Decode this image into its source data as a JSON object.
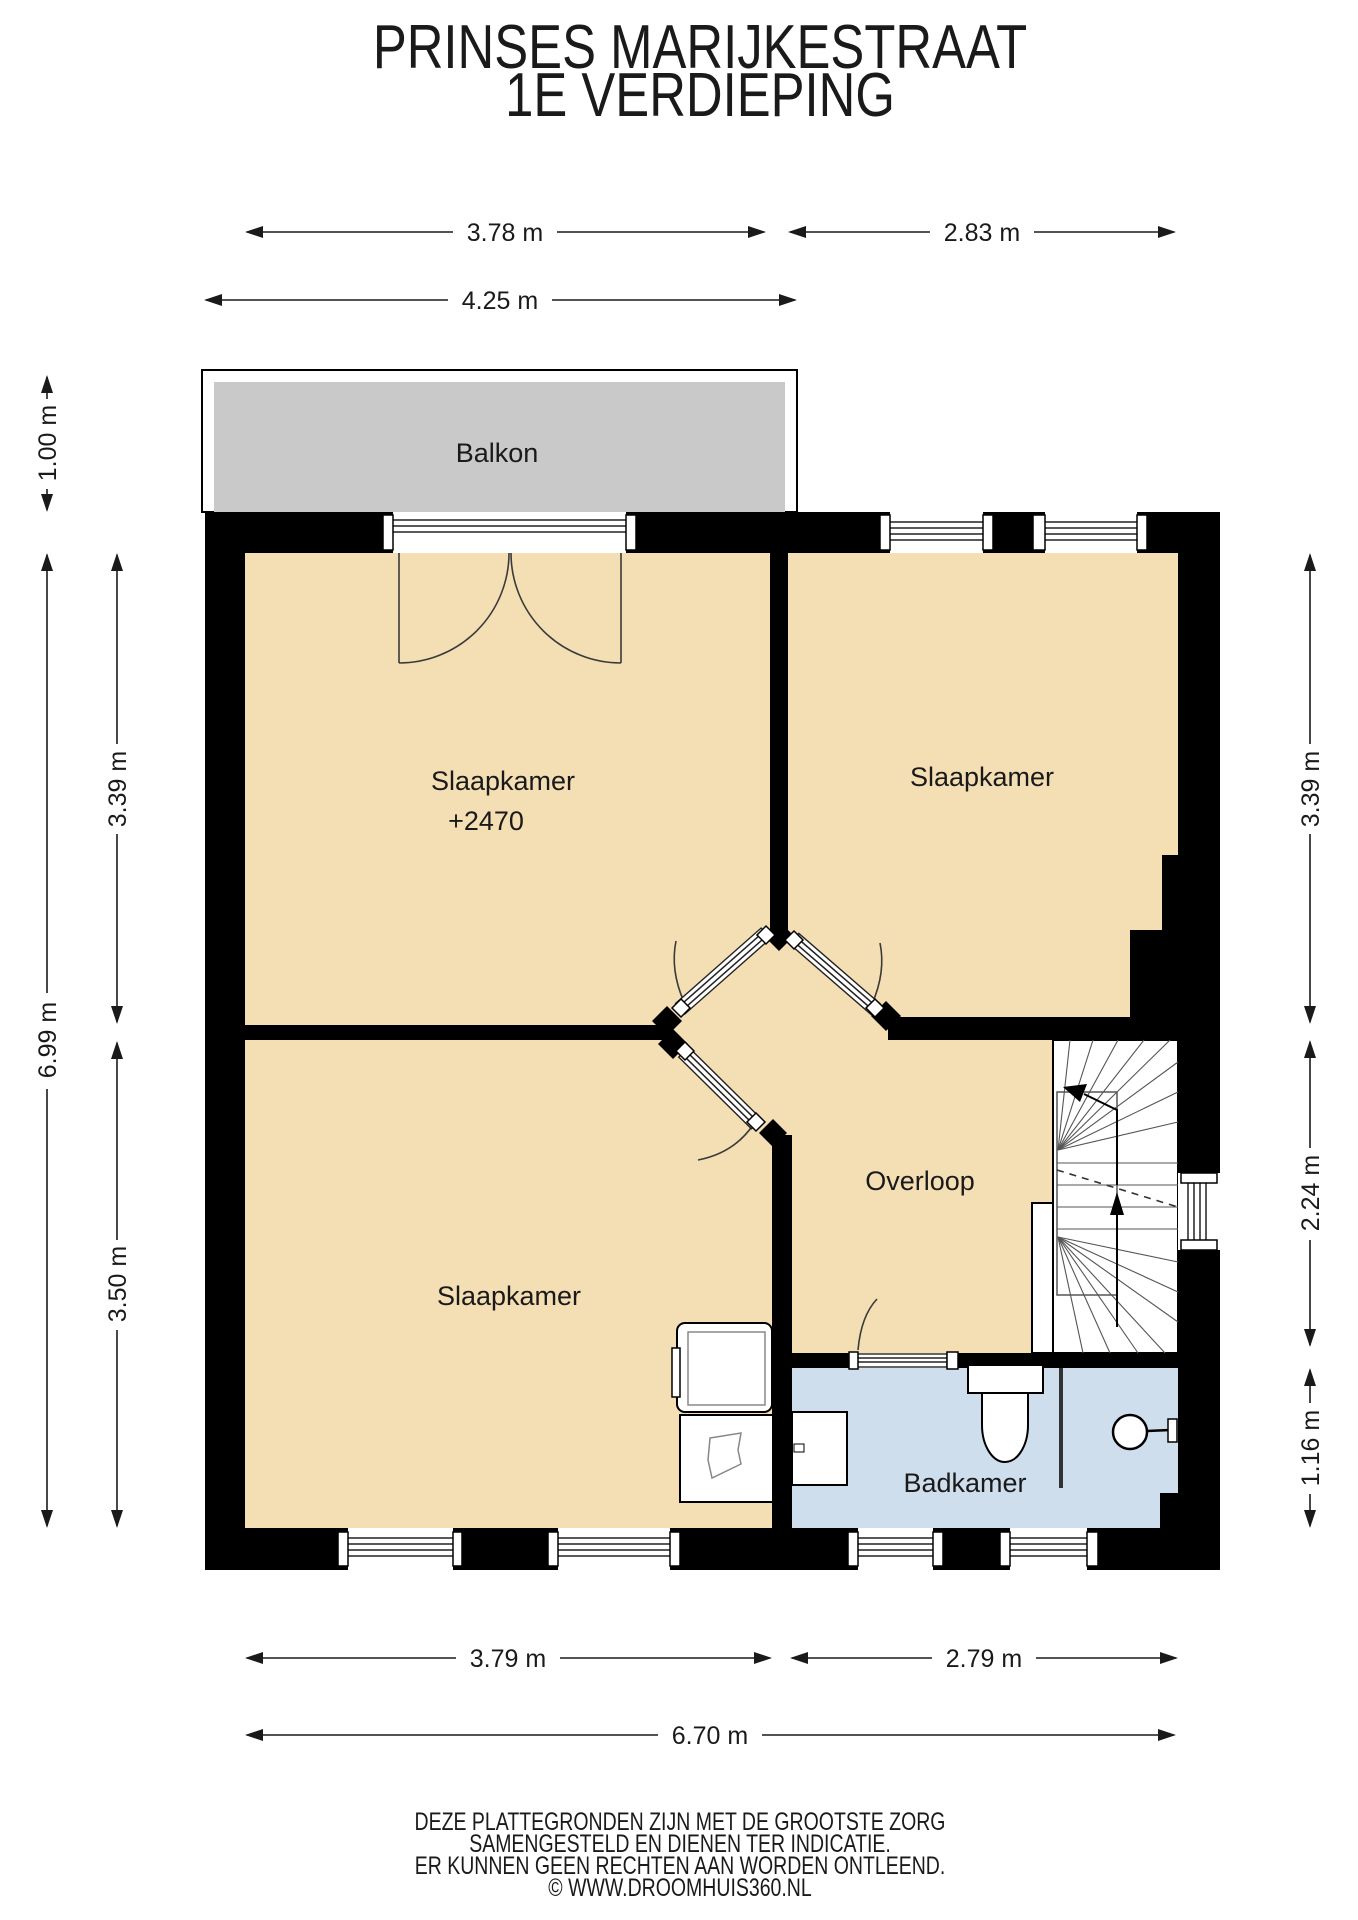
{
  "title": {
    "line1": "PRINSES MARIJKESTRAAT",
    "line2": "1E VERDIEPING"
  },
  "rooms": {
    "balcony": "Balkon",
    "bedroom_tl": "Slaapkamer",
    "bedroom_tl_level": "+2470",
    "bedroom_tr": "Slaapkamer",
    "bedroom_bl": "Slaapkamer",
    "landing": "Overloop",
    "bathroom": "Badkamer"
  },
  "dimensions": {
    "top_left_width": "3.78 m",
    "top_right_width": "2.83 m",
    "balcony_width": "4.25 m",
    "balcony_depth": "1.00 m",
    "left_upper": "3.39 m",
    "left_total": "6.99 m",
    "left_lower": "3.50 m",
    "right_upper": "3.39 m",
    "right_middle": "2.24 m",
    "right_lower": "1.16 m",
    "bottom_left_width": "3.79 m",
    "bottom_right_width": "2.79 m",
    "bottom_total_width": "6.70 m"
  },
  "footer": {
    "line1": "DEZE PLATTEGRONDEN ZIJN MET DE GROOTSTE ZORG",
    "line2": "SAMENGESTELD EN DIENEN TER INDICATIE.",
    "line3": "ER KUNNEN GEEN RECHTEN AAN WORDEN ONTLEEND.",
    "line4": "© WWW.DROOMHUIS360.NL"
  },
  "colors": {
    "wall": "#000000",
    "floor": "#F4DEB4",
    "bathroom_floor": "#CFDEED",
    "balcony_floor": "#C9C9C9",
    "dimension": "#1A1A1A"
  }
}
